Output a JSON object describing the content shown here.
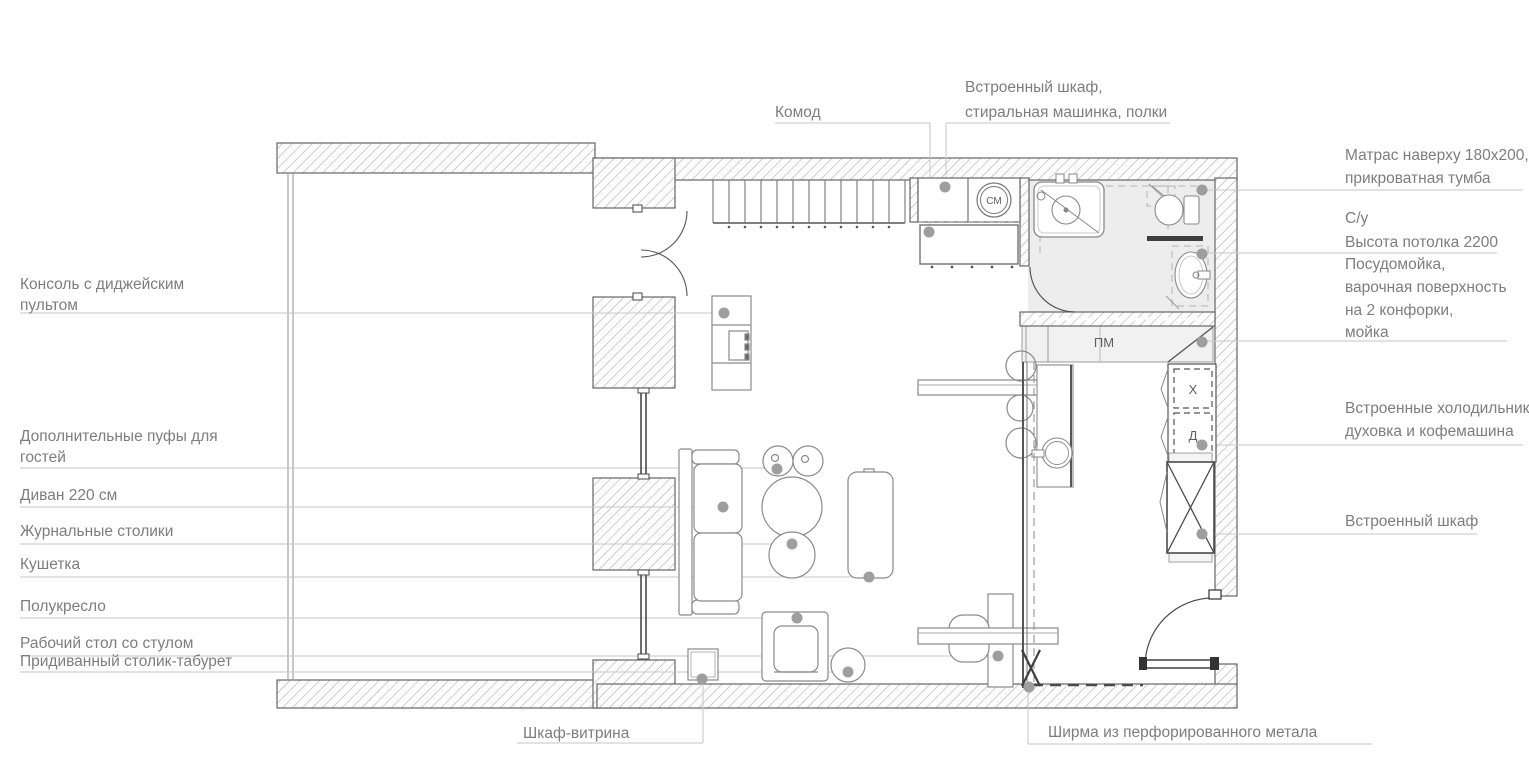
{
  "labels": {
    "left": [
      {
        "lines": [
          "Консоль с диджейским",
          "пультом"
        ]
      },
      {
        "lines": [
          "Дополнительные пуфы для",
          "гостей"
        ]
      },
      {
        "lines": [
          "Диван 220 см"
        ]
      },
      {
        "lines": [
          "Журнальные столики"
        ]
      },
      {
        "lines": [
          "Кушетка"
        ]
      },
      {
        "lines": [
          "Полукресло"
        ]
      },
      {
        "lines": [
          "Рабочий стол со стулом"
        ]
      },
      {
        "lines": [
          "Придиванный столик-табурет"
        ]
      }
    ],
    "top": [
      {
        "lines": [
          "Комод"
        ]
      },
      {
        "lines": [
          "Встроенный шкаф,",
          "стиральная машинка, полки"
        ]
      }
    ],
    "right": [
      {
        "lines": [
          "Матрас наверху 180x200,",
          "прикроватная тумба"
        ]
      },
      {
        "lines": [
          "С/у",
          "Высота потолка 2200"
        ]
      },
      {
        "lines": [
          "Посудомойка,",
          "варочная поверхность",
          "на 2 конфорки,",
          "мойка"
        ]
      },
      {
        "lines": [
          "Встроенные холодильник,",
          "духовка и кофемашина"
        ]
      },
      {
        "lines": [
          "Встроенный шкаф"
        ]
      }
    ],
    "bottom": [
      {
        "lines": [
          "Шкаф-витрина"
        ]
      },
      {
        "lines": [
          "Ширма из перфорированного метала"
        ]
      }
    ]
  },
  "marks": {
    "washing_machine": "СМ",
    "dishwasher": "ПМ",
    "fridge": "Х",
    "oven": "Д"
  },
  "colors": {
    "wall_outline": "#666666",
    "hatch_line": "#ababab",
    "leader_line": "#c6c6c6",
    "leader_dot": "#9e9e9e",
    "label_text": "#7d7d7d",
    "furniture_line": "#8a8a8a",
    "bathroom_fill": "#ededed",
    "kitchen_fill": "#f1f1f1"
  }
}
